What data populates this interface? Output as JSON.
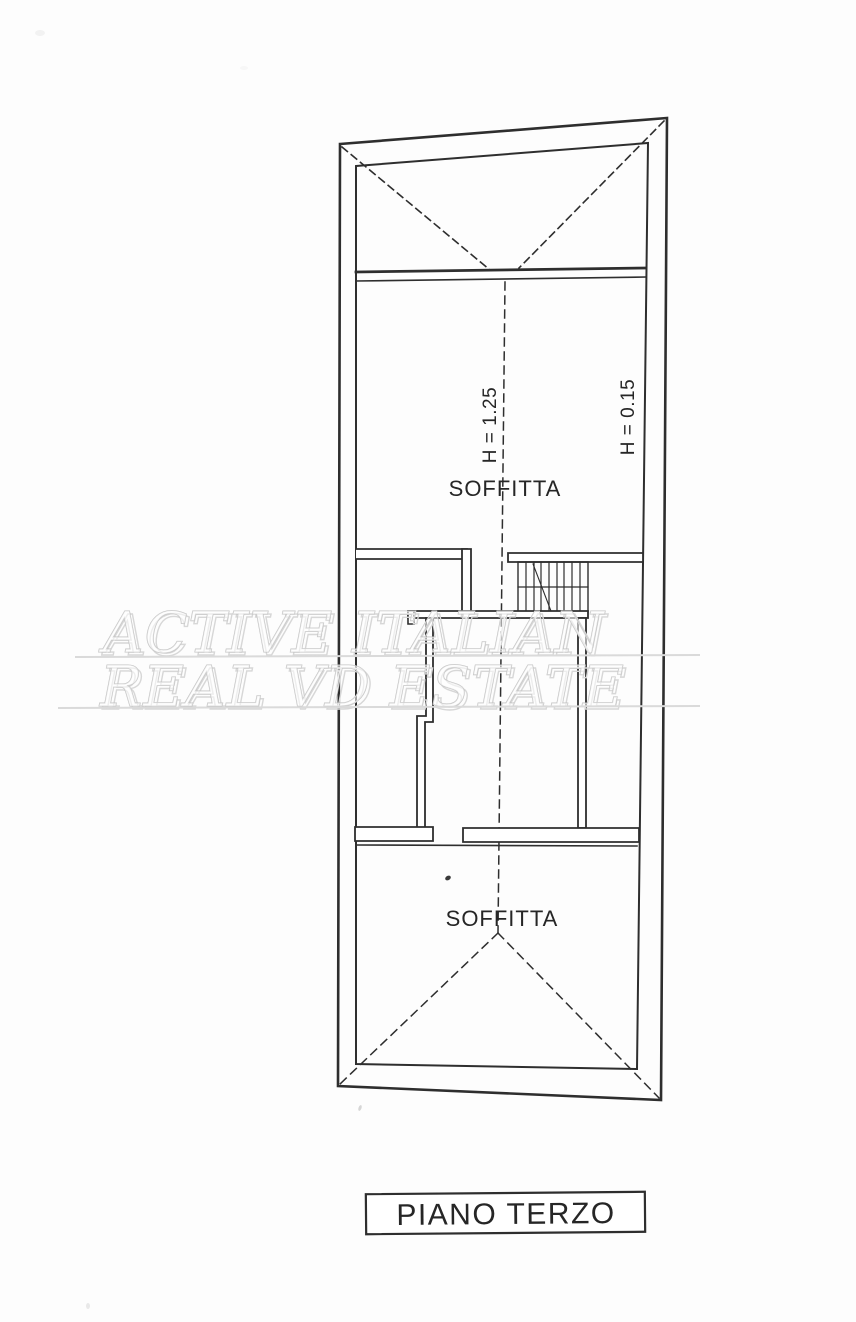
{
  "watermark": {
    "line1": "ACTIVE ITALIAN",
    "line2": "REAL VD ESTATE"
  },
  "plan": {
    "room_upper": {
      "label": "SOFFITTA"
    },
    "room_lower": {
      "label": "SOFFITTA"
    },
    "annotation_center": {
      "label": "H = 1.25"
    },
    "annotation_right": {
      "label": "H = 0.15"
    }
  },
  "footer": {
    "title": "PIANO TERZO"
  },
  "colors": {
    "line": "#2e2e2e",
    "background": "#fdfdfd",
    "watermark_stroke": "#c2c2c2",
    "watermark_fill": "rgba(255,255,255,0.55)",
    "underline": "#dadada"
  }
}
